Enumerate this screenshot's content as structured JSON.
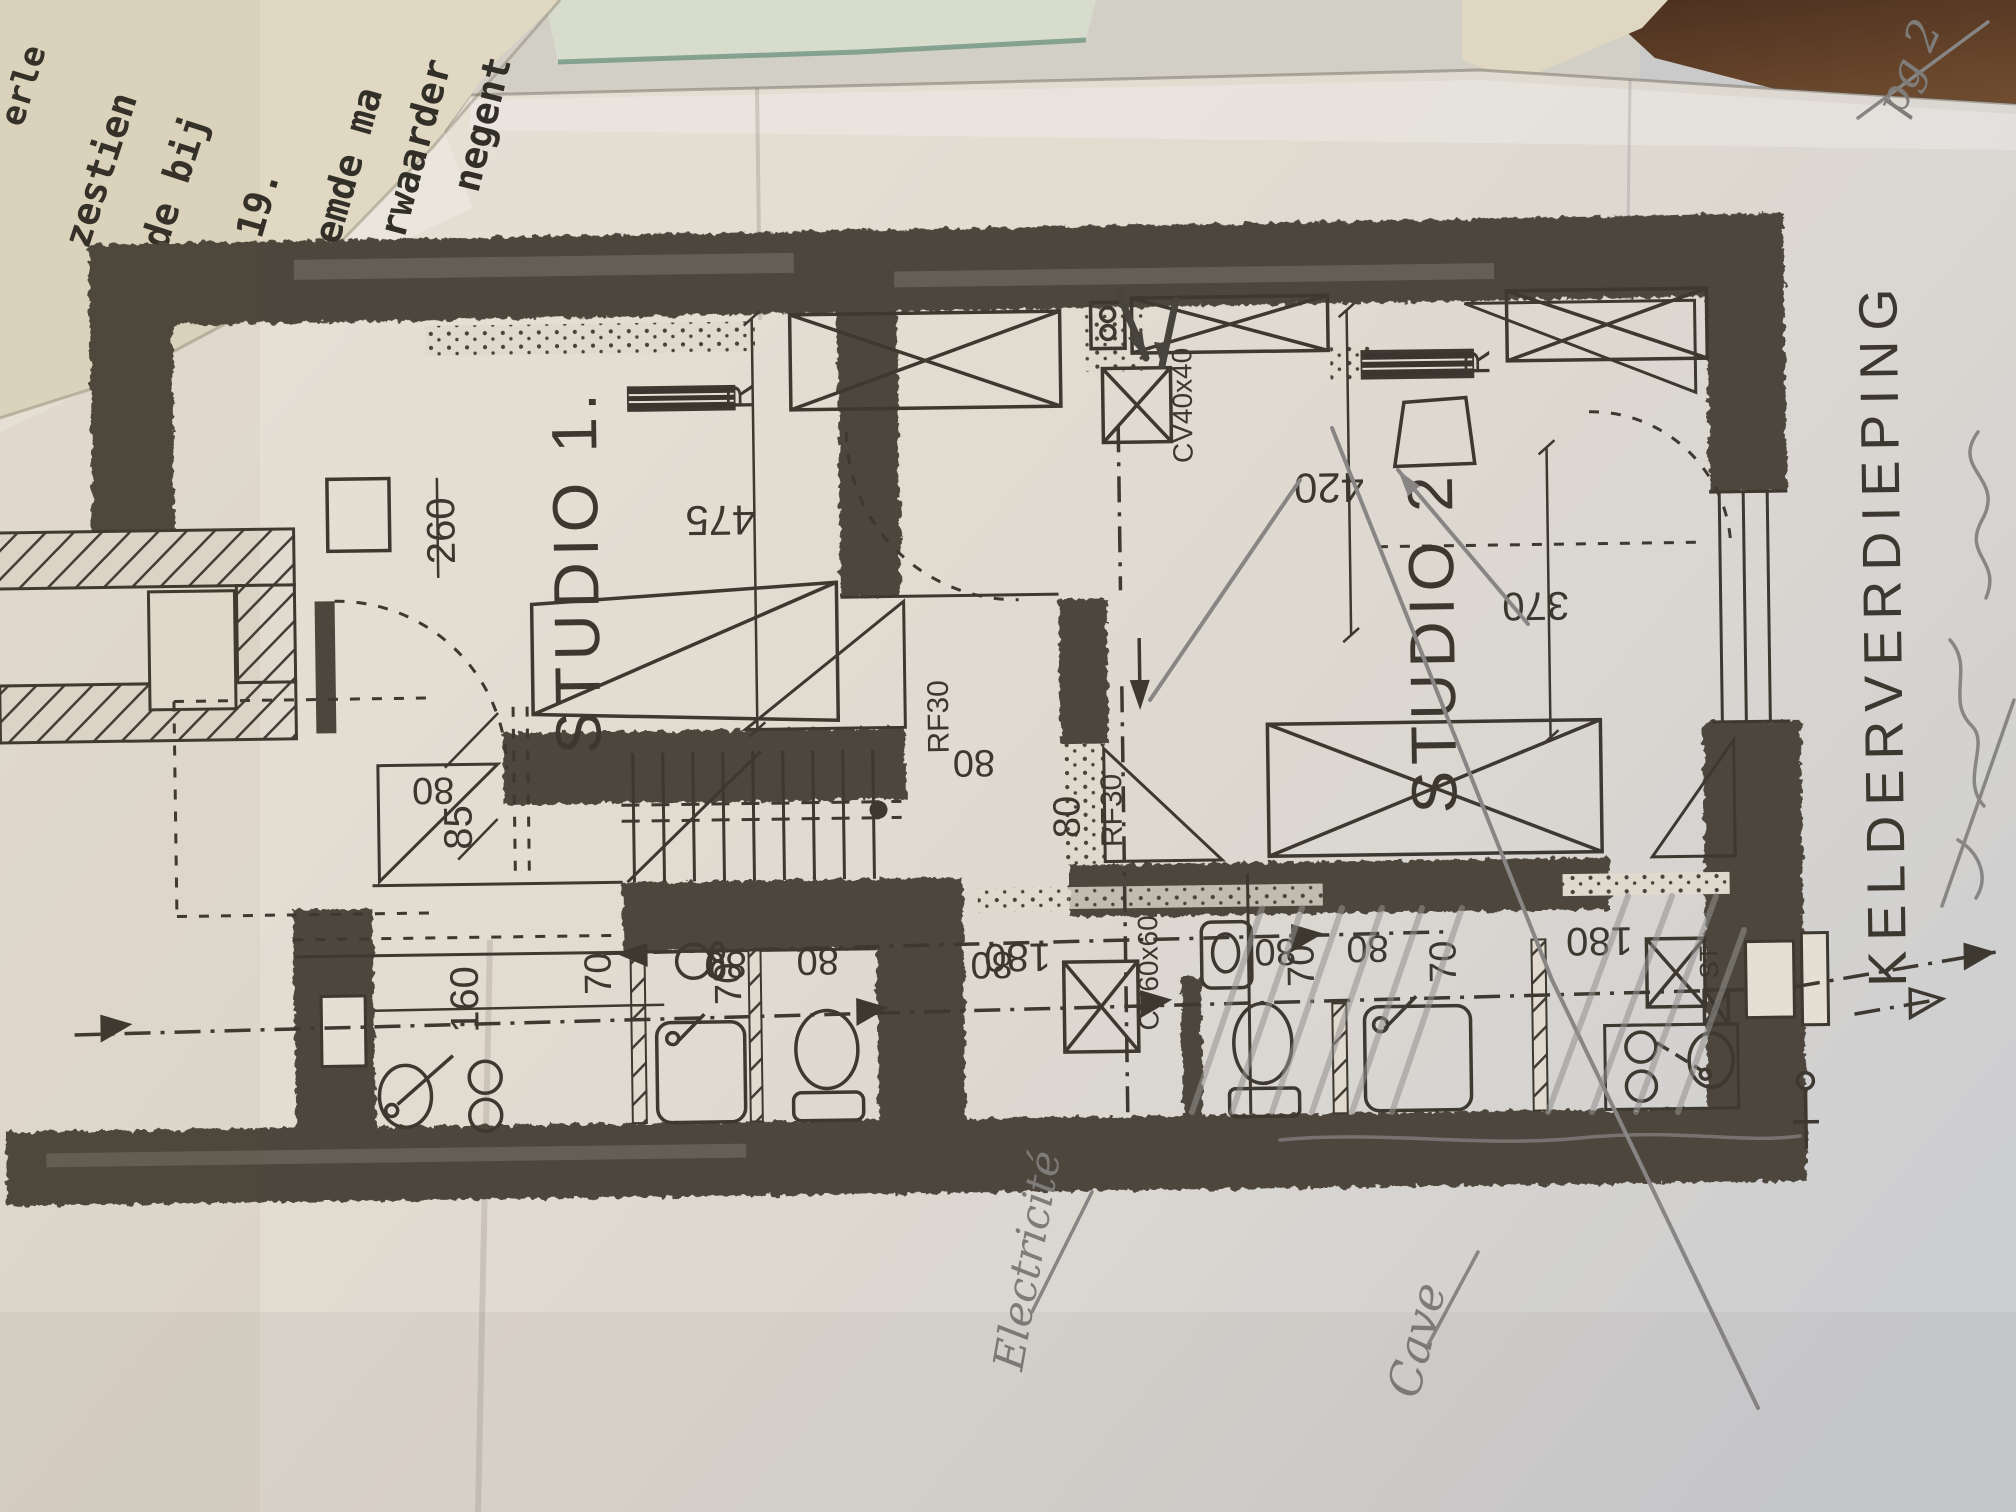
{
  "typed_paper": {
    "lines": [
      "erle",
      "zestien",
      "n de bij",
      "-19.",
      "oemde ma",
      "rwaarder",
      "negent"
    ]
  },
  "plan": {
    "title": "KELDERVERDIEPING",
    "rooms": {
      "studio1": "STUDIO 1.",
      "studio2": "STUDIO 2"
    },
    "labels": {
      "radiator": "R",
      "fire_door": "RF30",
      "boiler_40": "CV40x40",
      "boiler_60": "CV60x60",
      "st": "ST"
    },
    "dimensions": {
      "d475": "475",
      "d420": "420",
      "d370": "370",
      "d260": "260",
      "d180": "180",
      "d160": "160",
      "d85": "85",
      "d80": "80",
      "d70": "70"
    }
  },
  "annotations": {
    "page": "pg 2",
    "electricity": "Electricité",
    "cave": "Cave"
  }
}
